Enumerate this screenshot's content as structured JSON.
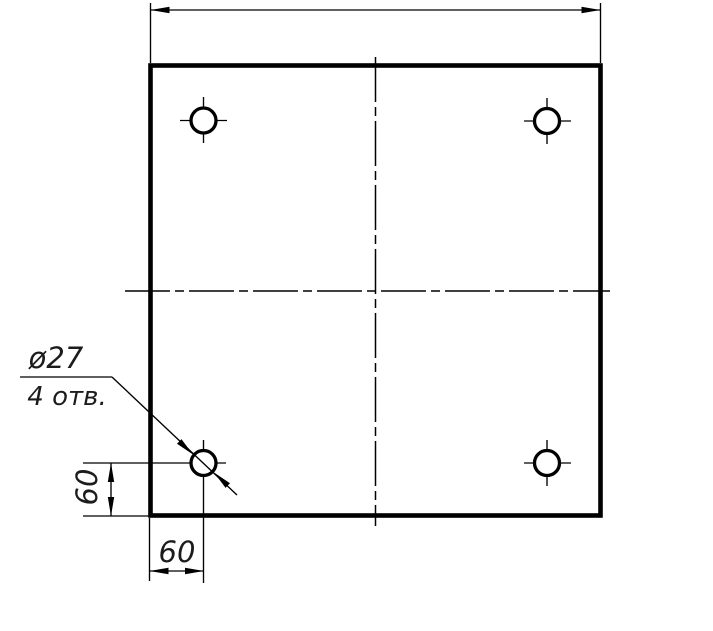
{
  "drawing": {
    "background_color": "#ffffff",
    "line_color": "#000000",
    "text_color": "#1c1c1c",
    "callout": {
      "diameter_label": "ø27",
      "holes_count_label": "4 отв."
    },
    "dimensions": {
      "hole_offset_horizontal": "60",
      "hole_offset_vertical": "60"
    }
  }
}
